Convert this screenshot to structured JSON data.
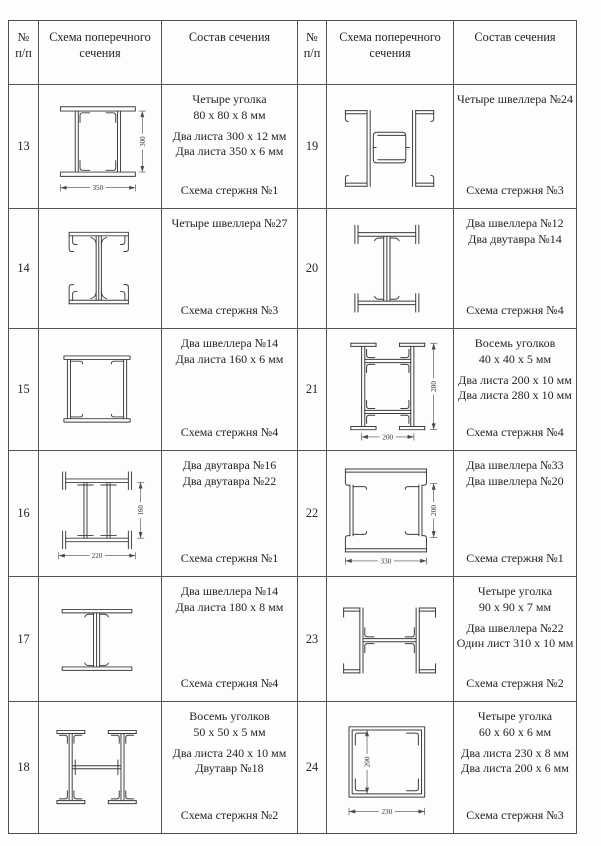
{
  "header": {
    "num_line1": "№",
    "num_line2": "п/п",
    "scheme": "Схема поперечного сечения",
    "composition": "Состав сечения"
  },
  "rows": [
    {
      "left": {
        "num": "13",
        "groups": [
          [
            "Четыре уголка",
            "80 х 80 х 8 мм"
          ],
          [
            "Два листа 300 х 12 мм",
            "Два листа 350 х 6 мм"
          ]
        ],
        "scheme": "Схема  стержня №1",
        "drawing": "r13",
        "dims": {
          "w": "350",
          "h": "300"
        }
      },
      "right": {
        "num": "19",
        "groups": [
          [
            "Четыре швеллера №24"
          ]
        ],
        "scheme": "Схема  стержня №3",
        "drawing": "r19",
        "dims": {}
      }
    },
    {
      "left": {
        "num": "14",
        "groups": [
          [
            "Четыре швеллера №27"
          ]
        ],
        "scheme": "Схема  стержня №3",
        "drawing": "r14",
        "dims": {}
      },
      "right": {
        "num": "20",
        "groups": [
          [
            "Два швеллера №12",
            "Два двутавра №14"
          ]
        ],
        "scheme": "Схема  стержня №4",
        "drawing": "r20",
        "dims": {}
      }
    },
    {
      "left": {
        "num": "15",
        "groups": [
          [
            "Два швеллера №14",
            "Два листа 160 х 6 мм"
          ]
        ],
        "scheme": "Схема  стержня №4",
        "drawing": "r15",
        "dims": {}
      },
      "right": {
        "num": "21",
        "groups": [
          [
            "Восемь уголков",
            "40 х 40 х 5 мм"
          ],
          [
            "Два листа 200 х 10 мм",
            "Два листа 280 х 10 мм"
          ]
        ],
        "scheme": "Схема  стержня №4",
        "drawing": "r21",
        "dims": {
          "w": "200",
          "h": "280"
        }
      }
    },
    {
      "left": {
        "num": "16",
        "groups": [
          [
            "Два двутавра №16",
            "Два двутавра №22"
          ]
        ],
        "scheme": "Схема  стержня №1",
        "drawing": "r16",
        "dims": {
          "w": "220",
          "h": "160"
        }
      },
      "right": {
        "num": "22",
        "groups": [
          [
            "Два швеллера №33",
            "Два швеллера №20"
          ]
        ],
        "scheme": "Схема  стержня №1",
        "drawing": "r22",
        "dims": {
          "w": "330",
          "h": "200"
        }
      }
    },
    {
      "left": {
        "num": "17",
        "groups": [
          [
            "Два швеллера №14",
            "Два листа 180 х 8 мм"
          ]
        ],
        "scheme": "Схема  стержня №4",
        "drawing": "r17",
        "dims": {}
      },
      "right": {
        "num": "23",
        "groups": [
          [
            "Четыре уголка",
            "90 х 90 х 7 мм"
          ],
          [
            "Два швеллера №22",
            "Один лист 310 х 10 мм"
          ]
        ],
        "scheme": "Схема  стержня №2",
        "drawing": "r23",
        "dims": {}
      }
    },
    {
      "left": {
        "num": "18",
        "groups": [
          [
            "Восемь уголков",
            "50 х 50 х 5 мм"
          ],
          [
            "Два листа 240 х 10 мм",
            "Двутавр №18"
          ]
        ],
        "scheme": "Схема  стержня №2",
        "drawing": "r18",
        "dims": {}
      },
      "right": {
        "num": "24",
        "groups": [
          [
            "Четыре уголка",
            "60 х 60 х 6 мм"
          ],
          [
            "Два листа 230 х 8 мм",
            "Два листа 200 х 6 мм"
          ]
        ],
        "scheme": "Схема  стержня №3",
        "drawing": "r24",
        "dims": {
          "w": "230",
          "h": "200"
        }
      }
    }
  ]
}
